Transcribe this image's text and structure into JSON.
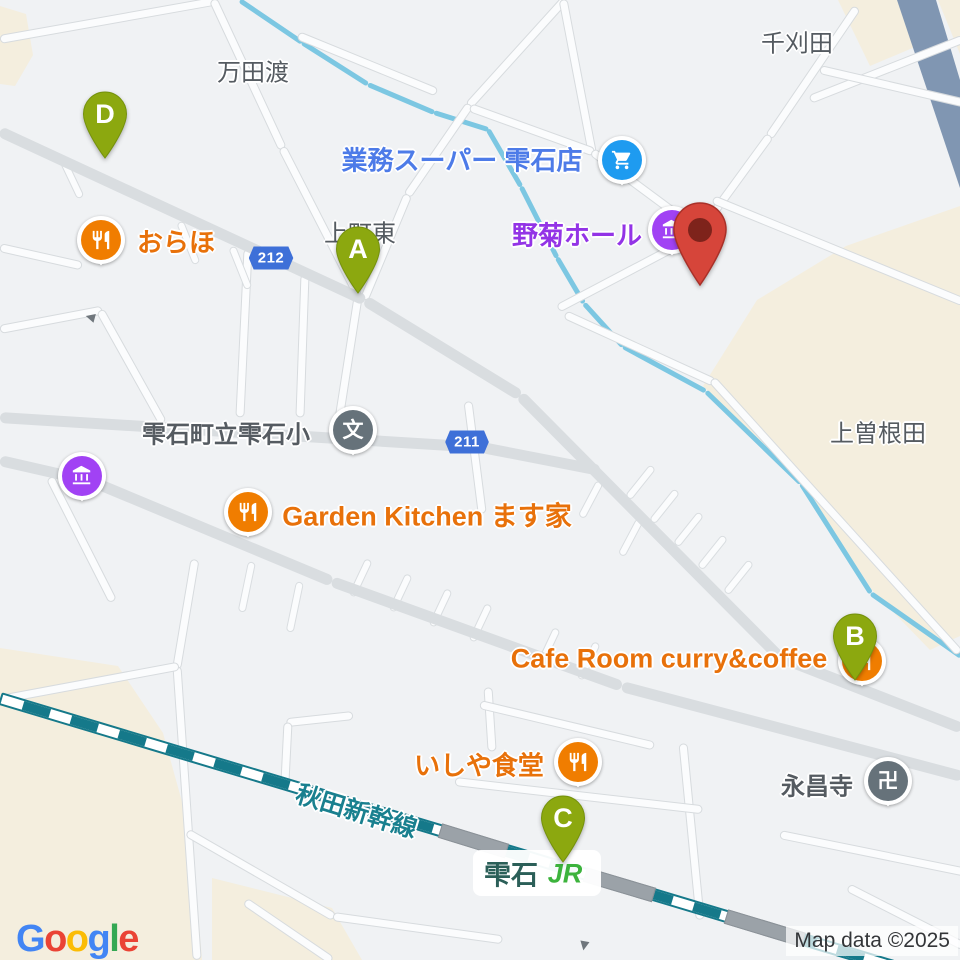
{
  "attribution": {
    "text": "Map data ©2025"
  },
  "google_logo": {
    "text": "Google",
    "letters": [
      {
        "ch": "G",
        "color": "#4285F4"
      },
      {
        "ch": "o",
        "color": "#EA4335"
      },
      {
        "ch": "o",
        "color": "#FBBC05"
      },
      {
        "ch": "g",
        "color": "#4285F4"
      },
      {
        "ch": "l",
        "color": "#34A853"
      },
      {
        "ch": "e",
        "color": "#EA4335"
      }
    ]
  },
  "districts": [
    {
      "id": "mandatawatari",
      "text": "万田渡",
      "x": 253,
      "y": 70,
      "size": 24
    },
    {
      "id": "senkarida",
      "text": "千刈田",
      "x": 797,
      "y": 41,
      "size": 24
    },
    {
      "id": "kamimachi-higashi",
      "text": "上町東",
      "x": 360,
      "y": 231,
      "size": 24
    },
    {
      "id": "kami-soneda",
      "text": "上曽根田",
      "x": 878,
      "y": 431,
      "size": 24
    }
  ],
  "pois": [
    {
      "id": "gyomu-super",
      "text": "業務スーパー 雫石店",
      "text_color": "#4D7BE8",
      "tx": 462,
      "ty": 159,
      "size": 26,
      "icon": "cart",
      "icon_color": "#1E9BF0",
      "ix": 622,
      "iy": 160
    },
    {
      "id": "nogiku-hall",
      "text": "野菊ホール",
      "text_color": "#9334E6",
      "tx": 577,
      "ty": 234,
      "size": 26,
      "icon": "hall",
      "icon_color": "#A142F4",
      "ix": 672,
      "iy": 230
    },
    {
      "id": "oraho",
      "text": "おらほ",
      "text_color": "#E8710A",
      "tx": 176,
      "ty": 241,
      "size": 26,
      "icon": "restaurant",
      "icon_color": "#F07D00",
      "ix": 101,
      "iy": 240
    },
    {
      "id": "shizukuishi-elementary",
      "text": "雫石町立雫石小",
      "text_color": "#555B61",
      "tx": 226,
      "ty": 432,
      "size": 24,
      "icon": "school",
      "icon_color": "#66727A",
      "ix": 353,
      "iy": 430
    },
    {
      "id": "museum",
      "text": "",
      "icon": "museum",
      "icon_color": "#A142F4",
      "ix": 82,
      "iy": 476
    },
    {
      "id": "garden-kitchen",
      "text": "Garden Kitchen ます家",
      "text_color": "#E8710A",
      "tx": 427,
      "ty": 514,
      "size": 27,
      "icon": "restaurant",
      "icon_color": "#F07D00",
      "ix": 248,
      "iy": 512
    },
    {
      "id": "cafe-room",
      "text": "Cafe Room curry&coffee",
      "text_color": "#E8710A",
      "tx": 669,
      "ty": 659,
      "size": 27,
      "icon": "restaurant",
      "icon_color": "#F07D00",
      "ix": 862,
      "iy": 661
    },
    {
      "id": "ishiya-shokudo",
      "text": "いしや食堂",
      "text_color": "#E8710A",
      "tx": 479,
      "ty": 764,
      "size": 26,
      "icon": "restaurant",
      "icon_color": "#F07D00",
      "ix": 578,
      "iy": 762
    },
    {
      "id": "eishoji",
      "text": "永昌寺",
      "text_color": "#555B61",
      "tx": 817,
      "ty": 784,
      "size": 24,
      "icon": "temple",
      "icon_color": "#66727A",
      "ix": 888,
      "iy": 781
    }
  ],
  "shields": [
    {
      "number": "212",
      "x": 271,
      "y": 258
    },
    {
      "number": "211",
      "x": 467,
      "y": 442
    }
  ],
  "markers": [
    {
      "letter": "A",
      "tip_x": 358,
      "tip_y": 293
    },
    {
      "letter": "B",
      "tip_x": 855,
      "tip_y": 680
    },
    {
      "letter": "C",
      "tip_x": 563,
      "tip_y": 862
    },
    {
      "letter": "D",
      "tip_x": 105,
      "tip_y": 158
    }
  ],
  "marker_color": "#8CA80F",
  "destination_marker": {
    "tip_x": 700,
    "tip_y": 285,
    "color": "#D6453A",
    "dot_color": "#7E231B"
  },
  "railway": {
    "label": "秋田新幹線",
    "label_color": "#19808F",
    "x": 357,
    "y": 810,
    "rotate": 17
  },
  "station": {
    "name": "雫石",
    "operator": "JR",
    "name_color": "#2B5F58",
    "operator_color": "#3CB33C"
  },
  "colors": {
    "background": "#F0F2F4",
    "land_beige": "#F4EEDE",
    "river_band": "#8096B2",
    "stream": "#7CC7E2",
    "road_major": "#D9DDE0",
    "road_minor": "#FBFCFD",
    "railway_teal": "#15798A",
    "district_label": "#555B61",
    "shield_blue": "#3E70D8"
  }
}
